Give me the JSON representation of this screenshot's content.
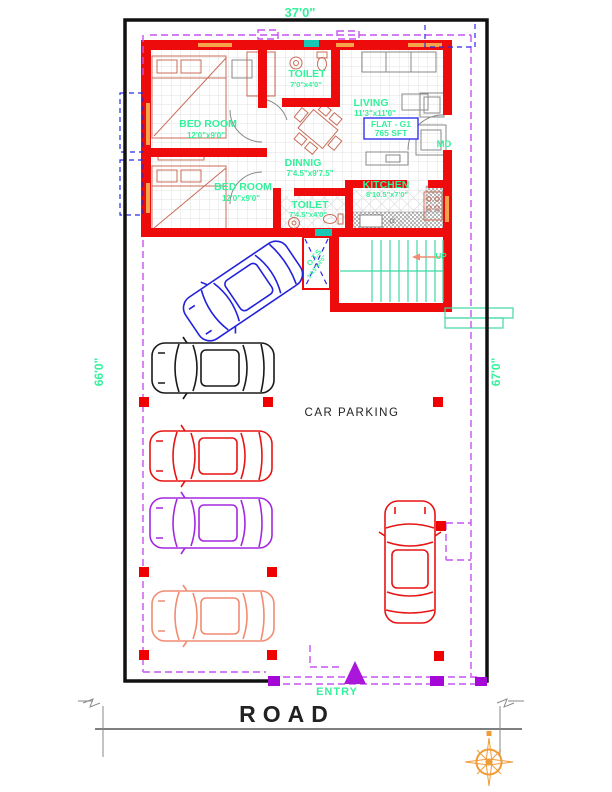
{
  "title": "Ground floor plan with car parking - FLAT G1",
  "colors": {
    "wall_red": "#EE0B0B",
    "label_green": "#35F19B",
    "dash_magenta": "#C653F2",
    "dash_blue": "#2A2AE8",
    "square_purple": "#A507D6",
    "column_red": "#F00000",
    "car_blue": "#2222DD",
    "car_black": "#1A1A1A",
    "car_red": "#E81414",
    "car_purple": "#A428E0",
    "car_salmon": "#F28C72",
    "stair_teal": "#3FD9A4",
    "window_orange": "#F5A44C",
    "vent_cyan": "#19C8B4",
    "fixture_red": "#C96C58",
    "furniture_gray": "#8A8A8A",
    "flat_box_blue": "#2222EE",
    "boundary_black": "#111111",
    "compass_orange": "#EF962E",
    "entry_purple": "#AB16DC"
  },
  "icons": {
    "compass": "compass-rose",
    "entry_marker": "triangle-up",
    "stair_direction": "arrow-left"
  },
  "labels": {
    "dim_top": "37'0\"",
    "dim_left": "66'0\"",
    "dim_right": "67'0\"",
    "bedroom1_name": "BED ROOM",
    "bedroom1_size": "12'0\"x9'0\"",
    "bedroom2_name": "BED ROOM",
    "bedroom2_size": "12'0\"x9'0\"",
    "toilet1_name": "TOILET",
    "toilet1_size": "7'0\"x4'0\"",
    "toilet2_name": "TOILET",
    "toilet2_size": "7'4.5\"x4'0\"",
    "living_name": "LIVING",
    "living_size": "11'3\"x11'0\"",
    "dining_name": "DINNIG",
    "dining_size": "7'4.5\"x9'7.5\"",
    "kitchen_name": "KITCHEN",
    "kitchen_size": "8'10.5\"x7'0\"",
    "ots_name": "O.T.S",
    "ots_size": "3'4.5\"x4'0\"",
    "flat_line1": "FLAT - G1",
    "flat_line2": "765 SFT",
    "door_md": "MD",
    "stair_up": "UP",
    "car_parking": "CAR PARKING",
    "entry": "ENTRY",
    "road": "ROAD"
  }
}
